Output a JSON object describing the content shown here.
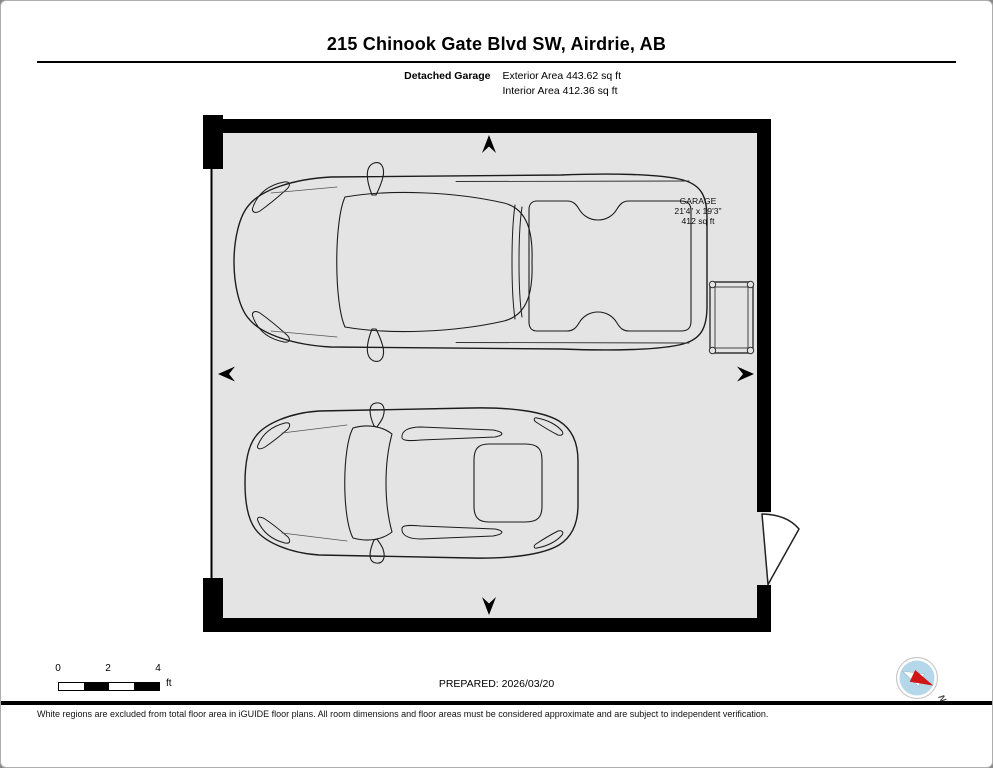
{
  "header": {
    "title": "215 Chinook Gate Blvd SW, Airdrie, AB",
    "floor_label": "Detached Garage",
    "area_lines": [
      "Exterior Area 443.62 sq ft",
      "Interior Area 412.36 sq ft"
    ]
  },
  "floorplan": {
    "room_label": {
      "name": "GARAGE",
      "dimensions": "21'4\" x 19'3\"",
      "area": "412 sq ft"
    },
    "objects": [
      "pickup-truck",
      "car",
      "table",
      "entry-door-swing",
      "garage-door",
      "direction-arrows"
    ],
    "floor_color": "#e4e4e4",
    "wall_color": "#000000"
  },
  "scale_bar": {
    "ticks": [
      "0",
      "2",
      "4"
    ],
    "unit": "ft"
  },
  "footer": {
    "prepared_label": "PREPARED: 2026/03/20",
    "disclaimer": "White regions are excluded from total floor area in iGUIDE floor plans. All room dimensions and floor areas must be considered approximate and are subject to independent verification.",
    "compass": {
      "label": "N",
      "disc_color": "#b4d8ea",
      "needle_north_color": "#d01616",
      "needle_south_color": "#ffffff"
    }
  }
}
